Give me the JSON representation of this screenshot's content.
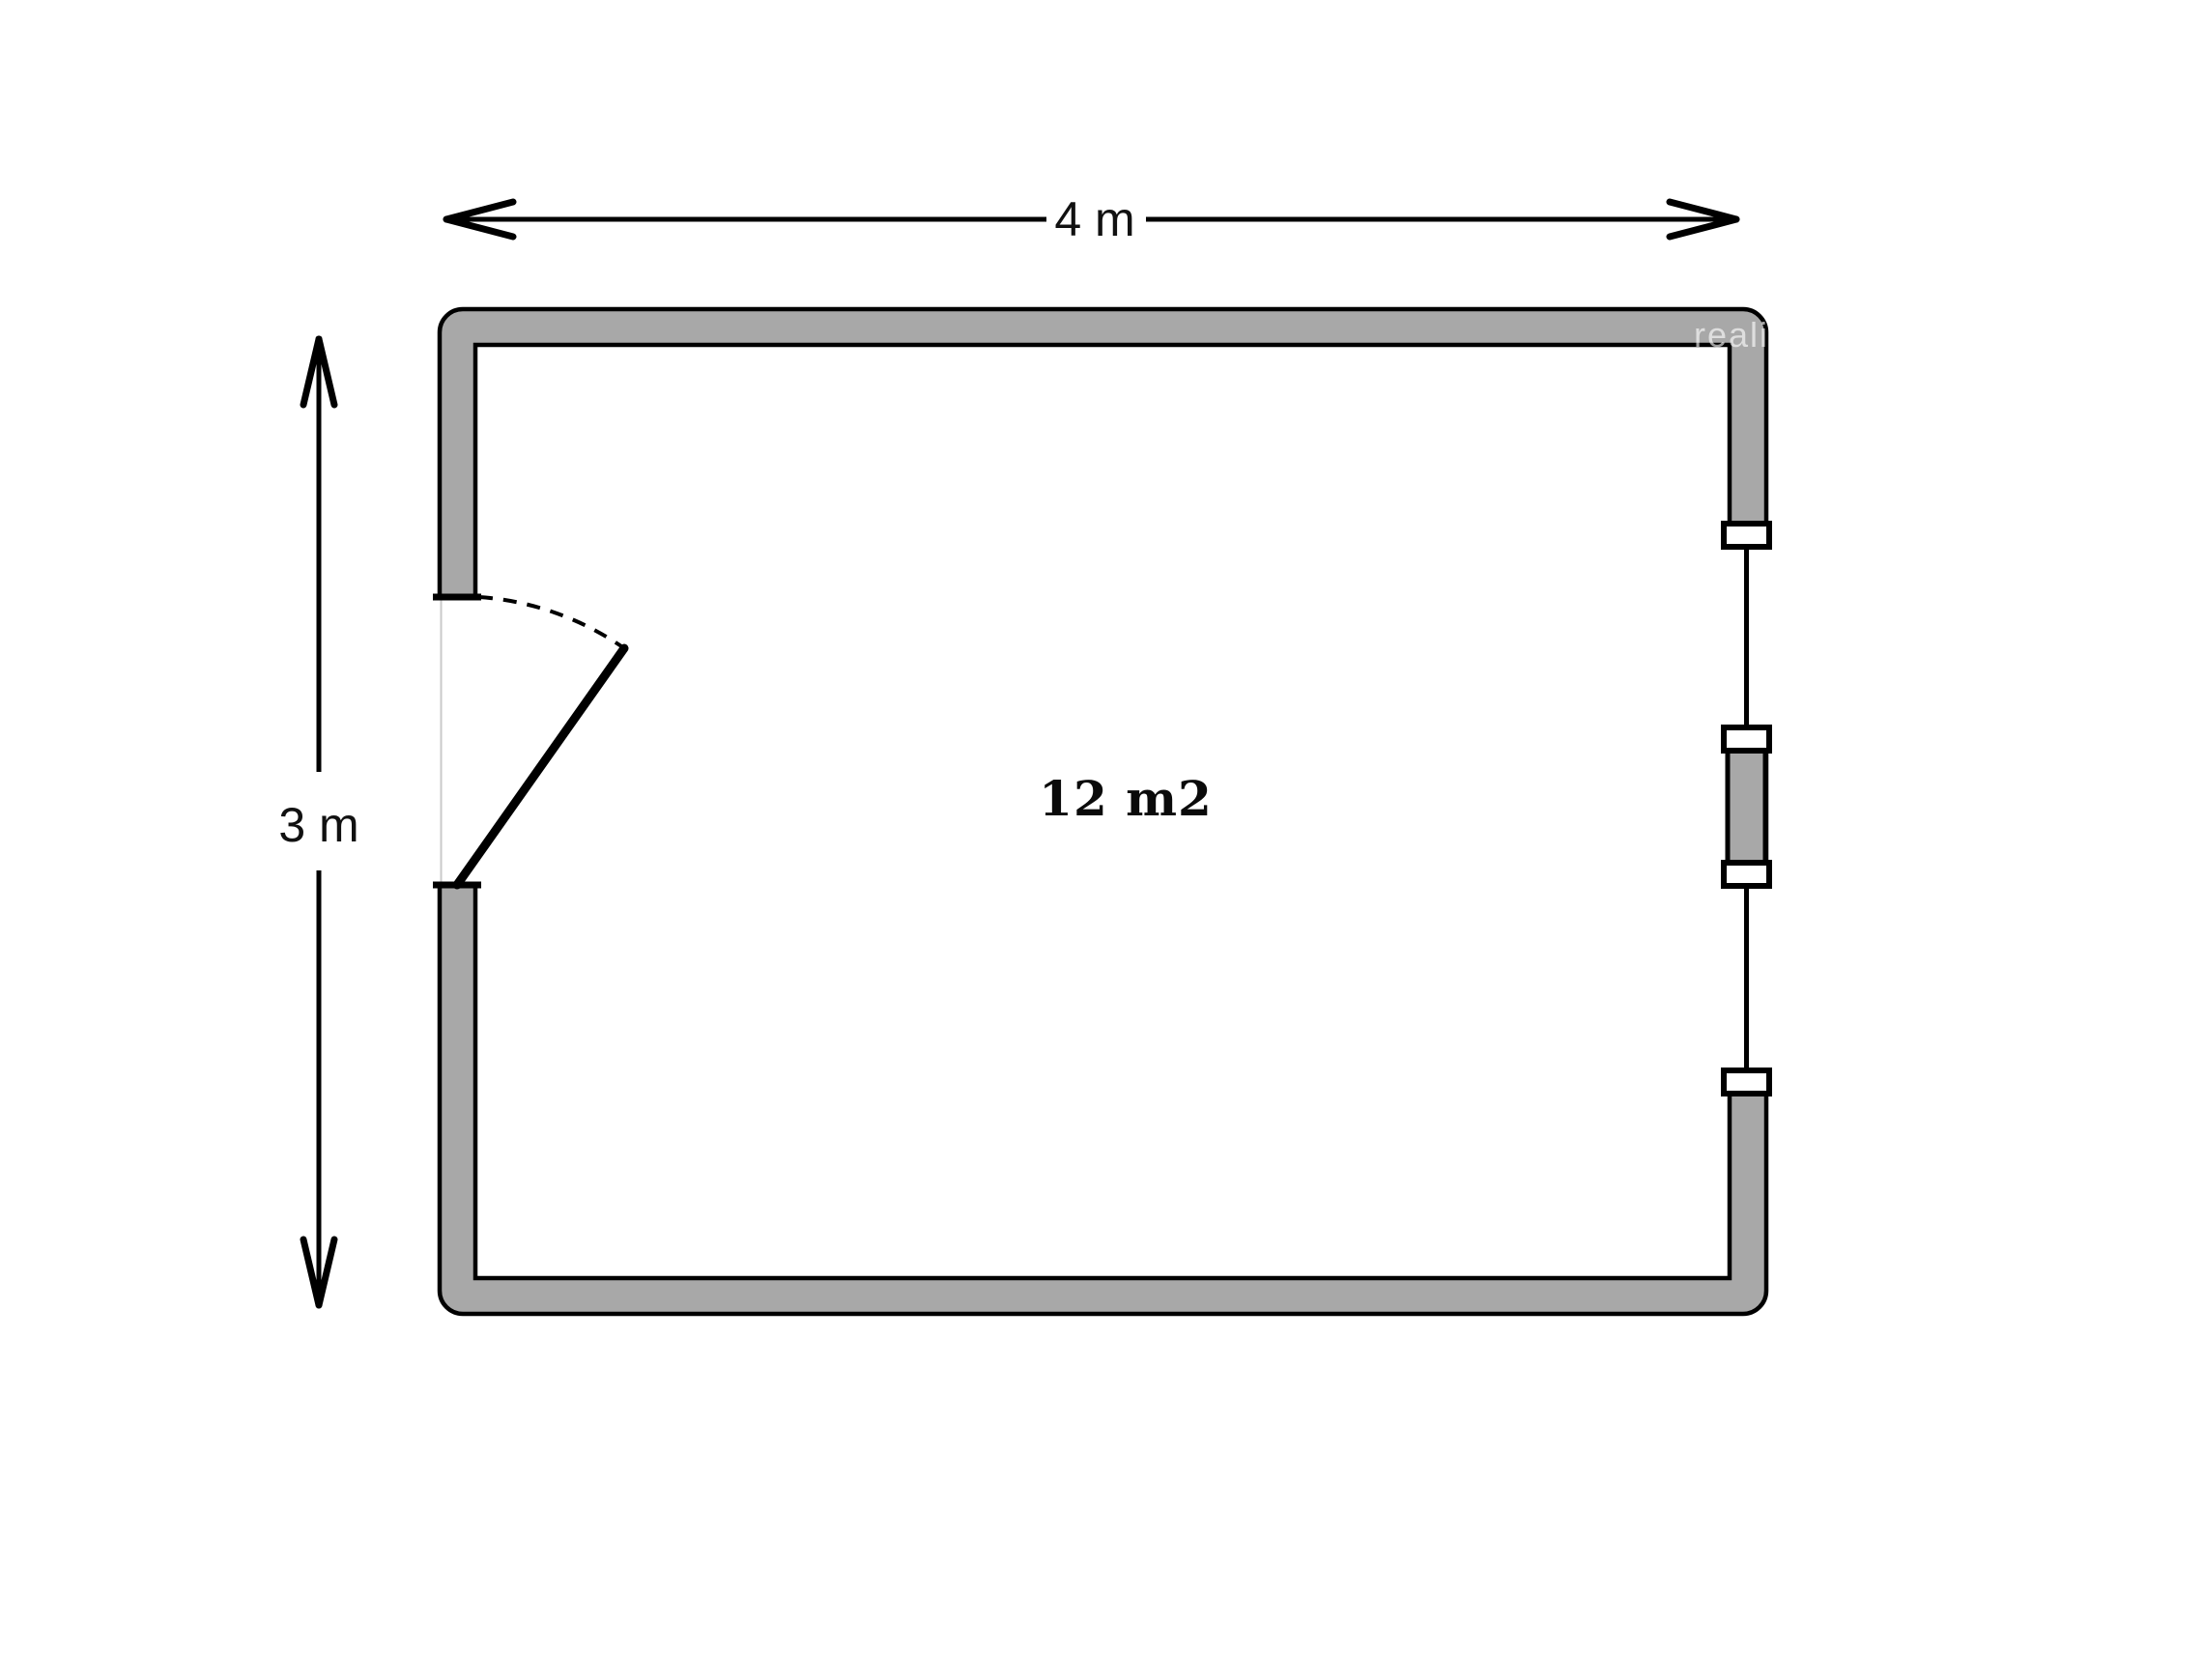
{
  "page": {
    "background": "#ffffff"
  },
  "floorplan": {
    "room": {
      "area_label": "12 m2",
      "width_label": "4 m",
      "height_label": "3 m"
    },
    "watermark": "realit",
    "colors": {
      "wall_fill": "#a8a8a8",
      "outline": "#000000",
      "door_gap_line": "#c9c9c9",
      "watermark_color": "rgba(255,255,255,0.62)"
    }
  }
}
